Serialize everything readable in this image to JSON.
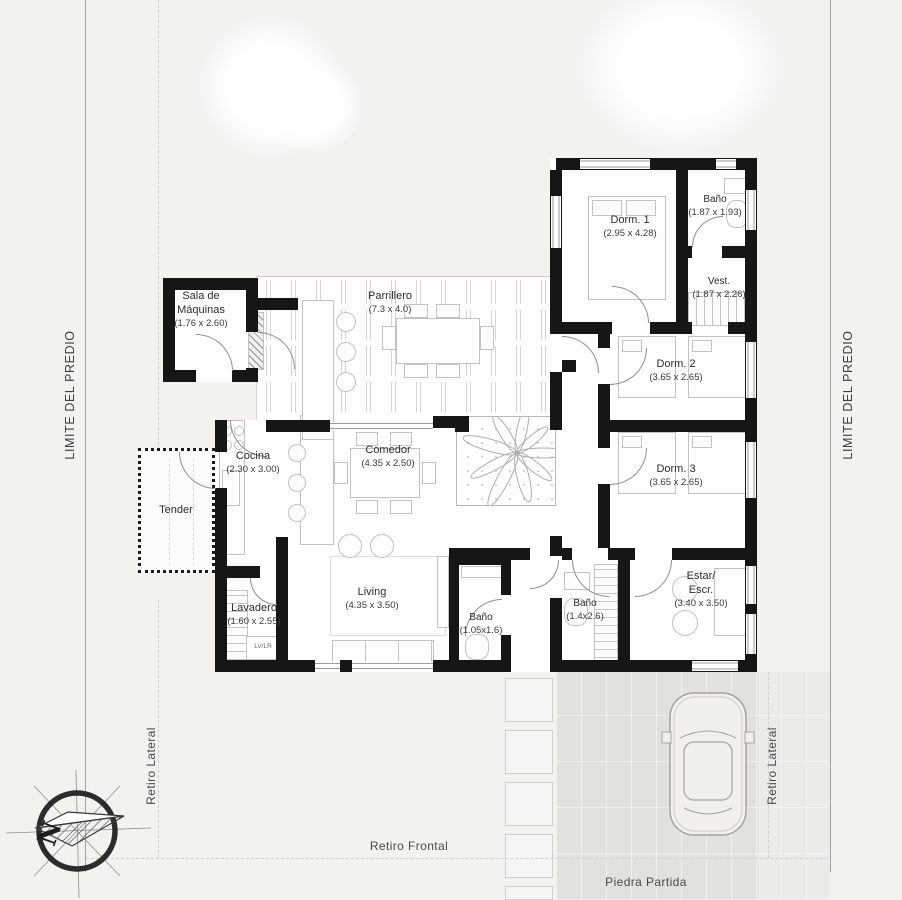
{
  "site": {
    "boundary_left_label": "LIMITE DEL PREDIO",
    "boundary_right_label": "LIMITE DEL PREDIO",
    "setback_left_label": "Retiro Lateral",
    "setback_right_label": "Retiro Lateral",
    "setback_front_label": "Retiro Frontal",
    "driveway_material_label": "Piedra Partida",
    "compass_letter": "N"
  },
  "rooms": {
    "sala_maquinas": {
      "name": "Sala de\nMáquinas",
      "dims": "(1.76 x 2.60)"
    },
    "parrillero": {
      "name": "Parrillero",
      "dims": "(7.3 x 4.0)"
    },
    "cocina": {
      "name": "Cocina",
      "dims": "(2.30 x 3.00)"
    },
    "comedor": {
      "name": "Comedor",
      "dims": "(4.35 x 2.50)"
    },
    "tender": {
      "name": "Tender",
      "dims": ""
    },
    "lavadero": {
      "name": "Lavadero",
      "dims": "(1.60 x 2.55)"
    },
    "living": {
      "name": "Living",
      "dims": "(4.35 x 3.50)"
    },
    "bano_principal": {
      "name": "Baño",
      "dims": "(1.05x1.6)"
    },
    "bano_suite": {
      "name": "Baño",
      "dims": "(1.4x2.6)"
    },
    "dorm1": {
      "name": "Dorm. 1",
      "dims": "(2.95 x 4.28)"
    },
    "bano_dorm": {
      "name": "Baño",
      "dims": "(1.87 x 1.93)"
    },
    "vestidor": {
      "name": "Vest.",
      "dims": "(1.87 x 2.26)"
    },
    "dorm2": {
      "name": "Dorm. 2",
      "dims": "(3.65 x 2.65)"
    },
    "dorm3": {
      "name": "Dorm. 3",
      "dims": "(3.65 x 2.65)"
    },
    "estar": {
      "name": "Estar/\nEscr.",
      "dims": "(3.40 x 3.50)"
    }
  },
  "annotations": {
    "laundry_label": "LV/LR"
  },
  "colors": {
    "wall": "#161616",
    "paper": "#f3f2ef",
    "driveway": "#e3e1dd",
    "text": "#2d2d2d"
  }
}
